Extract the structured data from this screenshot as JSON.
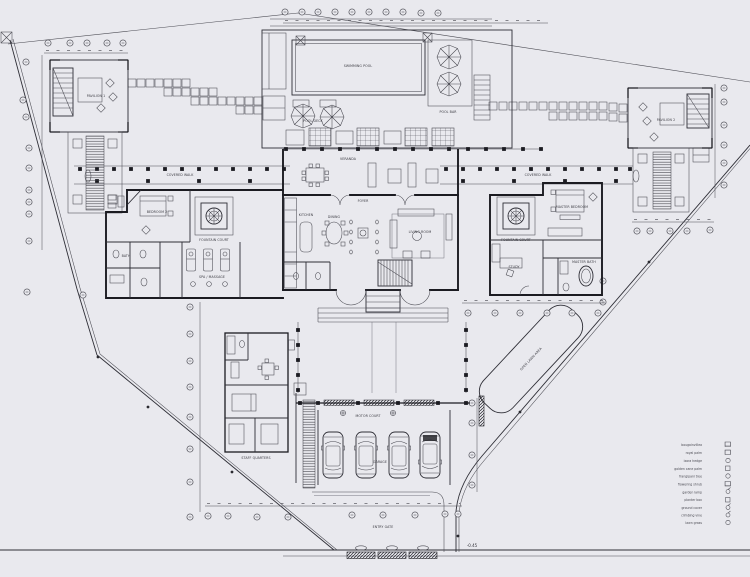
{
  "page": {
    "paper_color": "#e9e9ee",
    "ink_color": "#3a3a42",
    "wall_color": "#1b1b21",
    "drawing_type": "villa estate site / floor plan"
  },
  "labels": {
    "pool": "SWIMMING POOL",
    "deck": "POOL DECK",
    "bar": "POOL BAR",
    "pav1": "PAVILION 1",
    "pav2": "PAVILION 2",
    "walk_left": "COVERED WALK",
    "walk_right": "COVERED WALK",
    "veranda": "VERANDA",
    "foyer": "FOYER",
    "dining": "DINING",
    "kitchen": "KITCHEN",
    "living": "LIVING ROOM",
    "bed2": "BEDROOM 2",
    "bath2": "BATH",
    "spa": "SPA / MASSAGE",
    "court_left": "FOUNTAIN COURT",
    "court_right": "FOUNTAIN COURT",
    "mbr": "MASTER BEDROOM",
    "study": "STUDY",
    "mbath": "MASTER BATH",
    "staff": "STAFF QUARTERS",
    "garage": "GARAGE",
    "motor_court": "MOTOR COURT",
    "entry_gate": "ENTRY GATE",
    "lawn": "OPEN LAWN AREA",
    "level_note": "-0.45"
  },
  "legend": {
    "items": [
      {
        "label": "bougainvillea",
        "symbol": "grid-square"
      },
      {
        "label": "royal palm",
        "symbol": "grid-square"
      },
      {
        "label": "ixora hedge",
        "symbol": "circle"
      },
      {
        "label": "golden cane palm",
        "symbol": "square"
      },
      {
        "label": "frangipani tree",
        "symbol": "circle"
      },
      {
        "label": "flowering shrub",
        "symbol": "grid-square"
      },
      {
        "label": "garden lamp",
        "symbol": "lamp"
      },
      {
        "label": "planter box",
        "symbol": "square"
      },
      {
        "label": "ground cover",
        "symbol": "lamp"
      },
      {
        "label": "climbing vine",
        "symbol": "lamp"
      },
      {
        "label": "lawn grass",
        "symbol": "circle"
      }
    ]
  }
}
